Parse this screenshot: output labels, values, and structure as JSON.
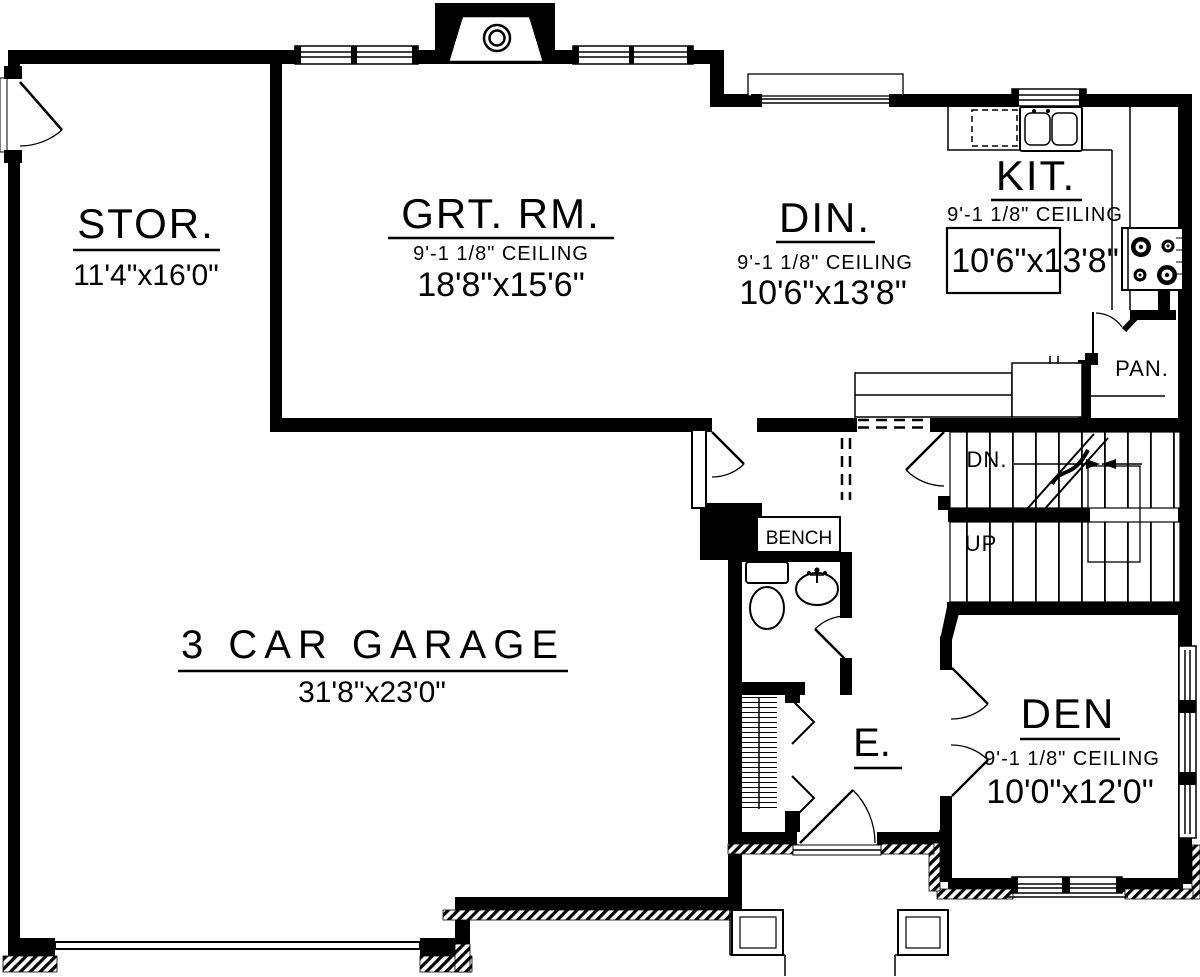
{
  "colors": {
    "ink": "#000000",
    "paper": "#ffffff"
  },
  "rooms": {
    "stor": {
      "name": "STOR.",
      "dims": "11'4\"x16'0\""
    },
    "great_room": {
      "name": "GRT. RM.",
      "ceiling": "9'-1 1/8\" CEILING",
      "dims": "18'8\"x15'6\""
    },
    "dining": {
      "name": "DIN.",
      "ceiling": "9'-1 1/8\" CEILING",
      "dims": "10'6\"x13'8\""
    },
    "kitchen": {
      "name": "KIT.",
      "ceiling": "9'-1 1/8\" CEILING",
      "dims": "10'6\"x13'8\""
    },
    "pantry": {
      "name": "PAN."
    },
    "garage": {
      "name": "3 CAR GARAGE",
      "dims": "31'8\"x23'0\""
    },
    "entry": {
      "name": "E."
    },
    "den": {
      "name": "DEN",
      "ceiling": "9'-1 1/8\" CEILING",
      "dims": "10'0\"x12'0\""
    }
  },
  "labels": {
    "bench": "BENCH",
    "stairs_down": "DN.",
    "stairs_up": "UP"
  }
}
